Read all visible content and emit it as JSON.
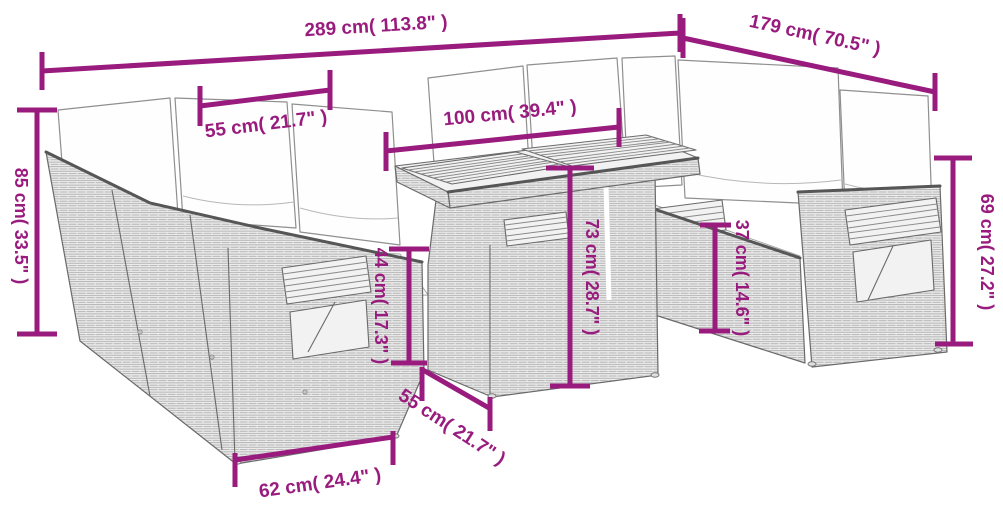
{
  "diagram": {
    "kind": "product-dimension-diagram",
    "drawing_style": "gray wicker line art with white cushions",
    "accent_color": "#981B7D",
    "background_color": "#ffffff"
  },
  "measurements": [
    {
      "id": "overall-width",
      "label": "289 cm( 113.8\" )"
    },
    {
      "id": "overall-depth",
      "label": "179 cm( 70.5\" )"
    },
    {
      "id": "back-height",
      "label": "85 cm( 33.5\" )"
    },
    {
      "id": "seat-width",
      "label": "55 cm( 21.7\" )"
    },
    {
      "id": "table-length",
      "label": "100 cm( 39.4\" )"
    },
    {
      "id": "table-height",
      "label": "73 cm( 28.7\" )"
    },
    {
      "id": "front-seat-height",
      "label": "44 cm( 17.3\" )"
    },
    {
      "id": "seat-height",
      "label": "37 cm( 14.6\" )"
    },
    {
      "id": "arm-height",
      "label": "69 cm( 27.2\" )"
    },
    {
      "id": "table-depth",
      "label": "55 cm( 21.7\" )"
    },
    {
      "id": "module-width",
      "label": "62 cm( 24.4\" )"
    }
  ]
}
